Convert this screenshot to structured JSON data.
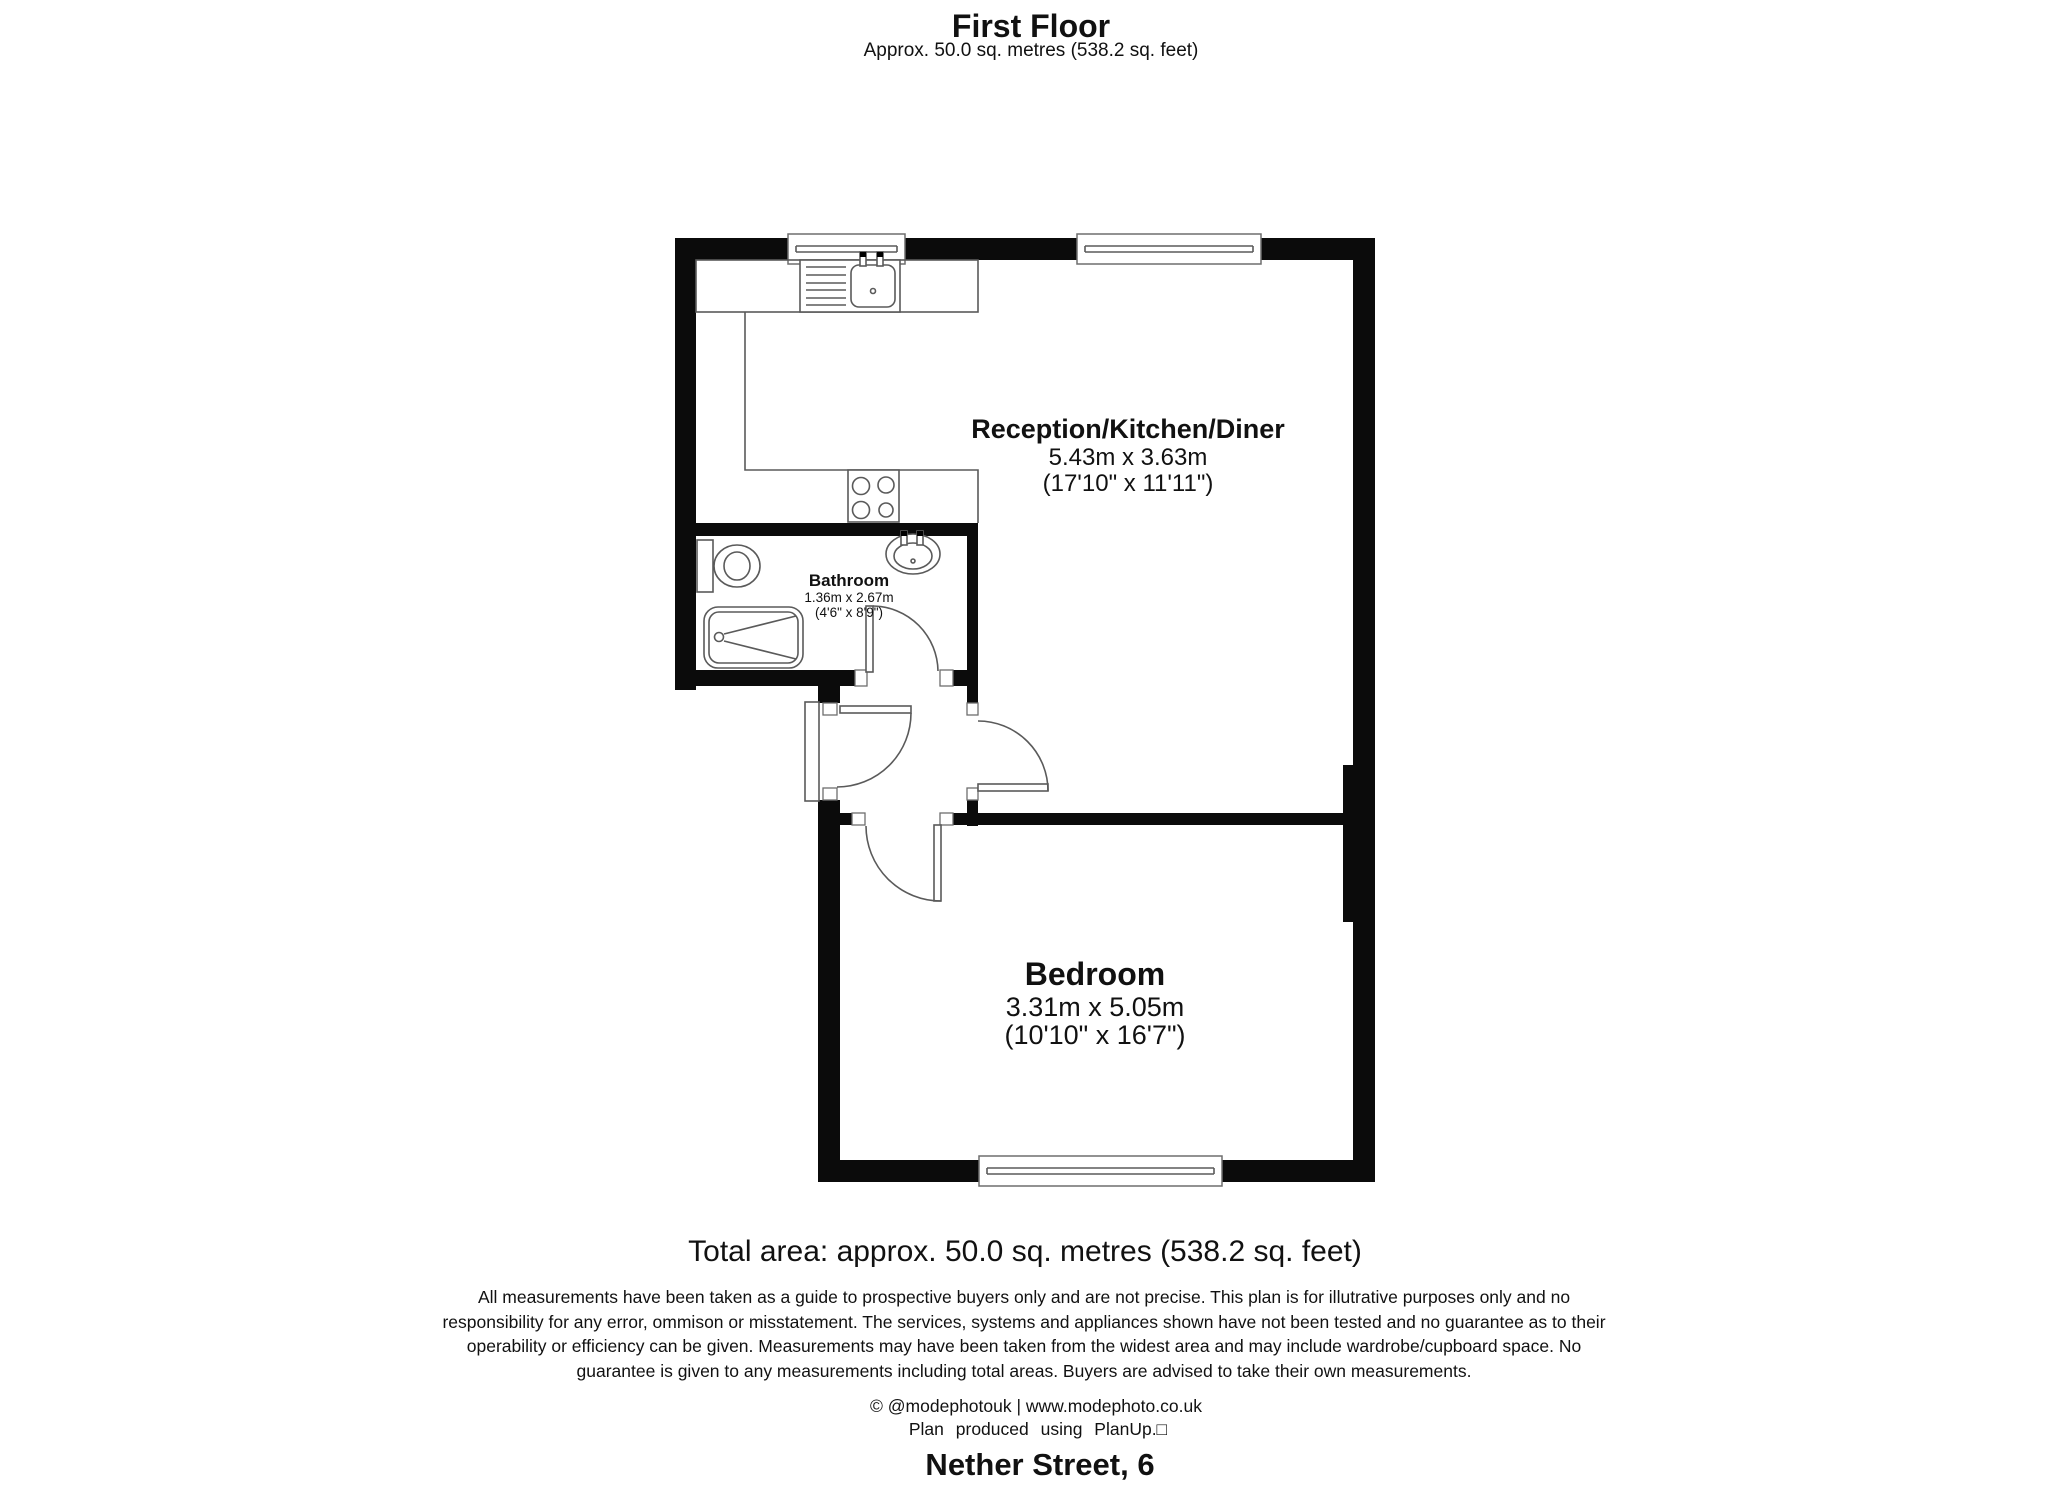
{
  "header": {
    "title": "First Floor",
    "subtitle": "Approx. 50.0 sq. metres (538.2 sq. feet)"
  },
  "rooms": {
    "reception": {
      "name": "Reception/Kitchen/Diner",
      "dimensions_metric": "5.43m x 3.63m",
      "dimensions_imperial": "(17'10\" x 11'11\")"
    },
    "bathroom": {
      "name": "Bathroom",
      "dimensions_metric": "1.36m x 2.67m",
      "dimensions_imperial": "(4'6\" x 8'9\")"
    },
    "bedroom": {
      "name": "Bedroom",
      "dimensions_metric": "3.31m x 5.05m",
      "dimensions_imperial": "(10'10\" x 16'7\")"
    }
  },
  "summary": {
    "total_area": "Total area: approx. 50.0 sq. metres (538.2 sq. feet)"
  },
  "disclaimer": {
    "lines": [
      "All measurements have been taken as a guide to prospective buyers only and are not precise. This plan is for illutrative purposes only and no",
      "responsibility for any error, ommison or misstatement. The services, systems and appliances shown have not been tested and no guarantee as to their",
      "operability or efficiency can be given. Measurements may have been taken from the widest area and may include wardrobe/cupboard space. No",
      "guarantee is given to any measurements including total areas. Buyers are advised to take their own measurements."
    ]
  },
  "footer": {
    "credit": "© @modephotouk | www.modephoto.co.uk",
    "produced": "Plan produced using PlanUp.□",
    "address": "Nether Street, 6"
  },
  "colors": {
    "wall": "#0b0b0b",
    "line": "#5a5a5a",
    "text": "#111111"
  }
}
